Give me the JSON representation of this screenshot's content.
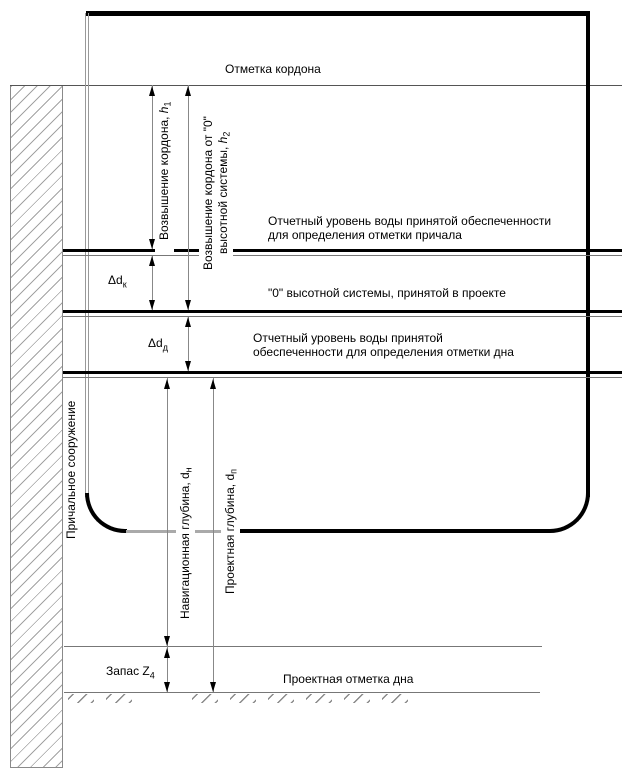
{
  "figure": {
    "title_hint": "Схема отметок и глубин у причального сооружения",
    "cordon_mark": "Отметка кордона",
    "level_berth": "Отчетный уровень воды принятой обеспеченности\nдля определения отметки причала",
    "zero_system": "\"0\" высотной системы, принятой в проекте",
    "level_bottom": "Отчетный уровень воды принятой\nобеспеченности для определения отметки дна",
    "bottom_mark": "Проектная отметка дна",
    "berth_structure": "Причальное сооружение"
  },
  "dimensions": {
    "h1": {
      "text": "Возвышение кордона, ",
      "var": "h",
      "sub": "1"
    },
    "h2": {
      "line1": "Возвышение кордона от \"0\"",
      "line2": "высотной системы, ",
      "var": "h",
      "sub": "2"
    },
    "dk": {
      "text": "Δd",
      "sub": "к"
    },
    "dd": {
      "text": "Δd",
      "sub": "д"
    },
    "dn": {
      "text": "Навигационная глубина, d",
      "sub": "н"
    },
    "dp": {
      "text": "Проектная глубина, d",
      "sub": "п"
    },
    "z4": {
      "text": "Запас Z",
      "sub": "4"
    }
  },
  "colors": {
    "ink": "#000000",
    "dim_line": "#888888",
    "hatch": "#a3a3a3",
    "background": "#ffffff"
  }
}
